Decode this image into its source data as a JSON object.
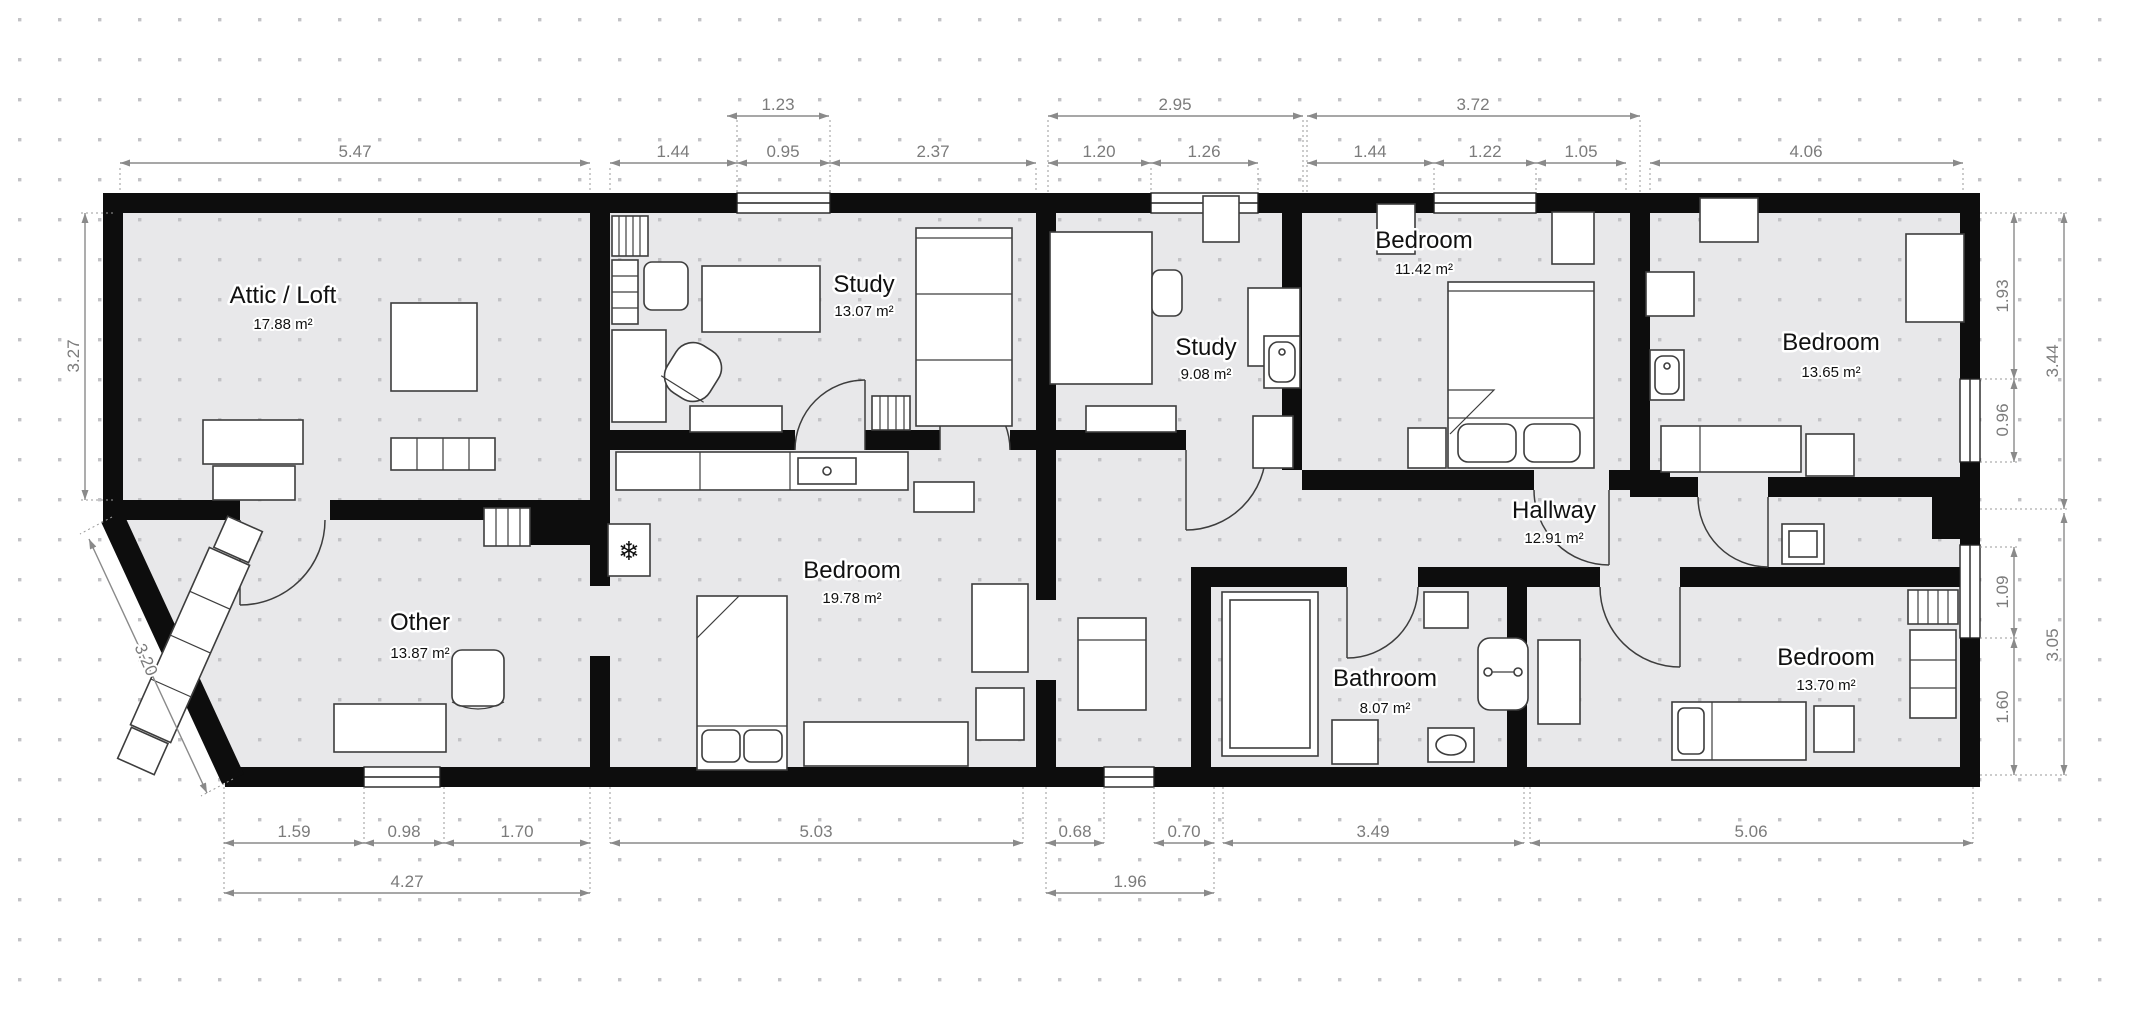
{
  "plan": {
    "rooms": [
      {
        "name": "Attic / Loft",
        "area": "17.88 m²"
      },
      {
        "name": "Study",
        "area": "13.07 m²"
      },
      {
        "name": "Study",
        "area": "9.08 m²"
      },
      {
        "name": "Bedroom",
        "area": "11.42 m²"
      },
      {
        "name": "Bedroom",
        "area": "13.65 m²"
      },
      {
        "name": "Hallway",
        "area": "12.91 m²"
      },
      {
        "name": "Other",
        "area": "13.87 m²"
      },
      {
        "name": "Bedroom",
        "area": "19.78 m²"
      },
      {
        "name": "Bathroom",
        "area": "8.07 m²"
      },
      {
        "name": "Bedroom",
        "area": "13.70 m²"
      }
    ],
    "dims": {
      "top1": [
        "1.23",
        "2.95",
        "3.72"
      ],
      "top2": [
        "5.47",
        "1.44",
        "0.95",
        "2.37",
        "1.20",
        "1.26",
        "1.44",
        "1.22",
        "1.05",
        "4.06"
      ],
      "left": [
        "3.27",
        "3.20"
      ],
      "right": [
        "1.93",
        "0.96",
        "3.44",
        "1.09",
        "1.60",
        "3.05"
      ],
      "bottom1": [
        "1.59",
        "0.98",
        "1.70",
        "5.03",
        "0.68",
        "0.70",
        "3.49",
        "5.06"
      ],
      "bottom2": [
        "4.27",
        "1.96"
      ]
    },
    "icons": {
      "freezer": "❄"
    },
    "colors": {
      "wall": "#0d0d0d",
      "room_fill": "#e8e8ea",
      "dimension": "#8a8a8a"
    }
  }
}
